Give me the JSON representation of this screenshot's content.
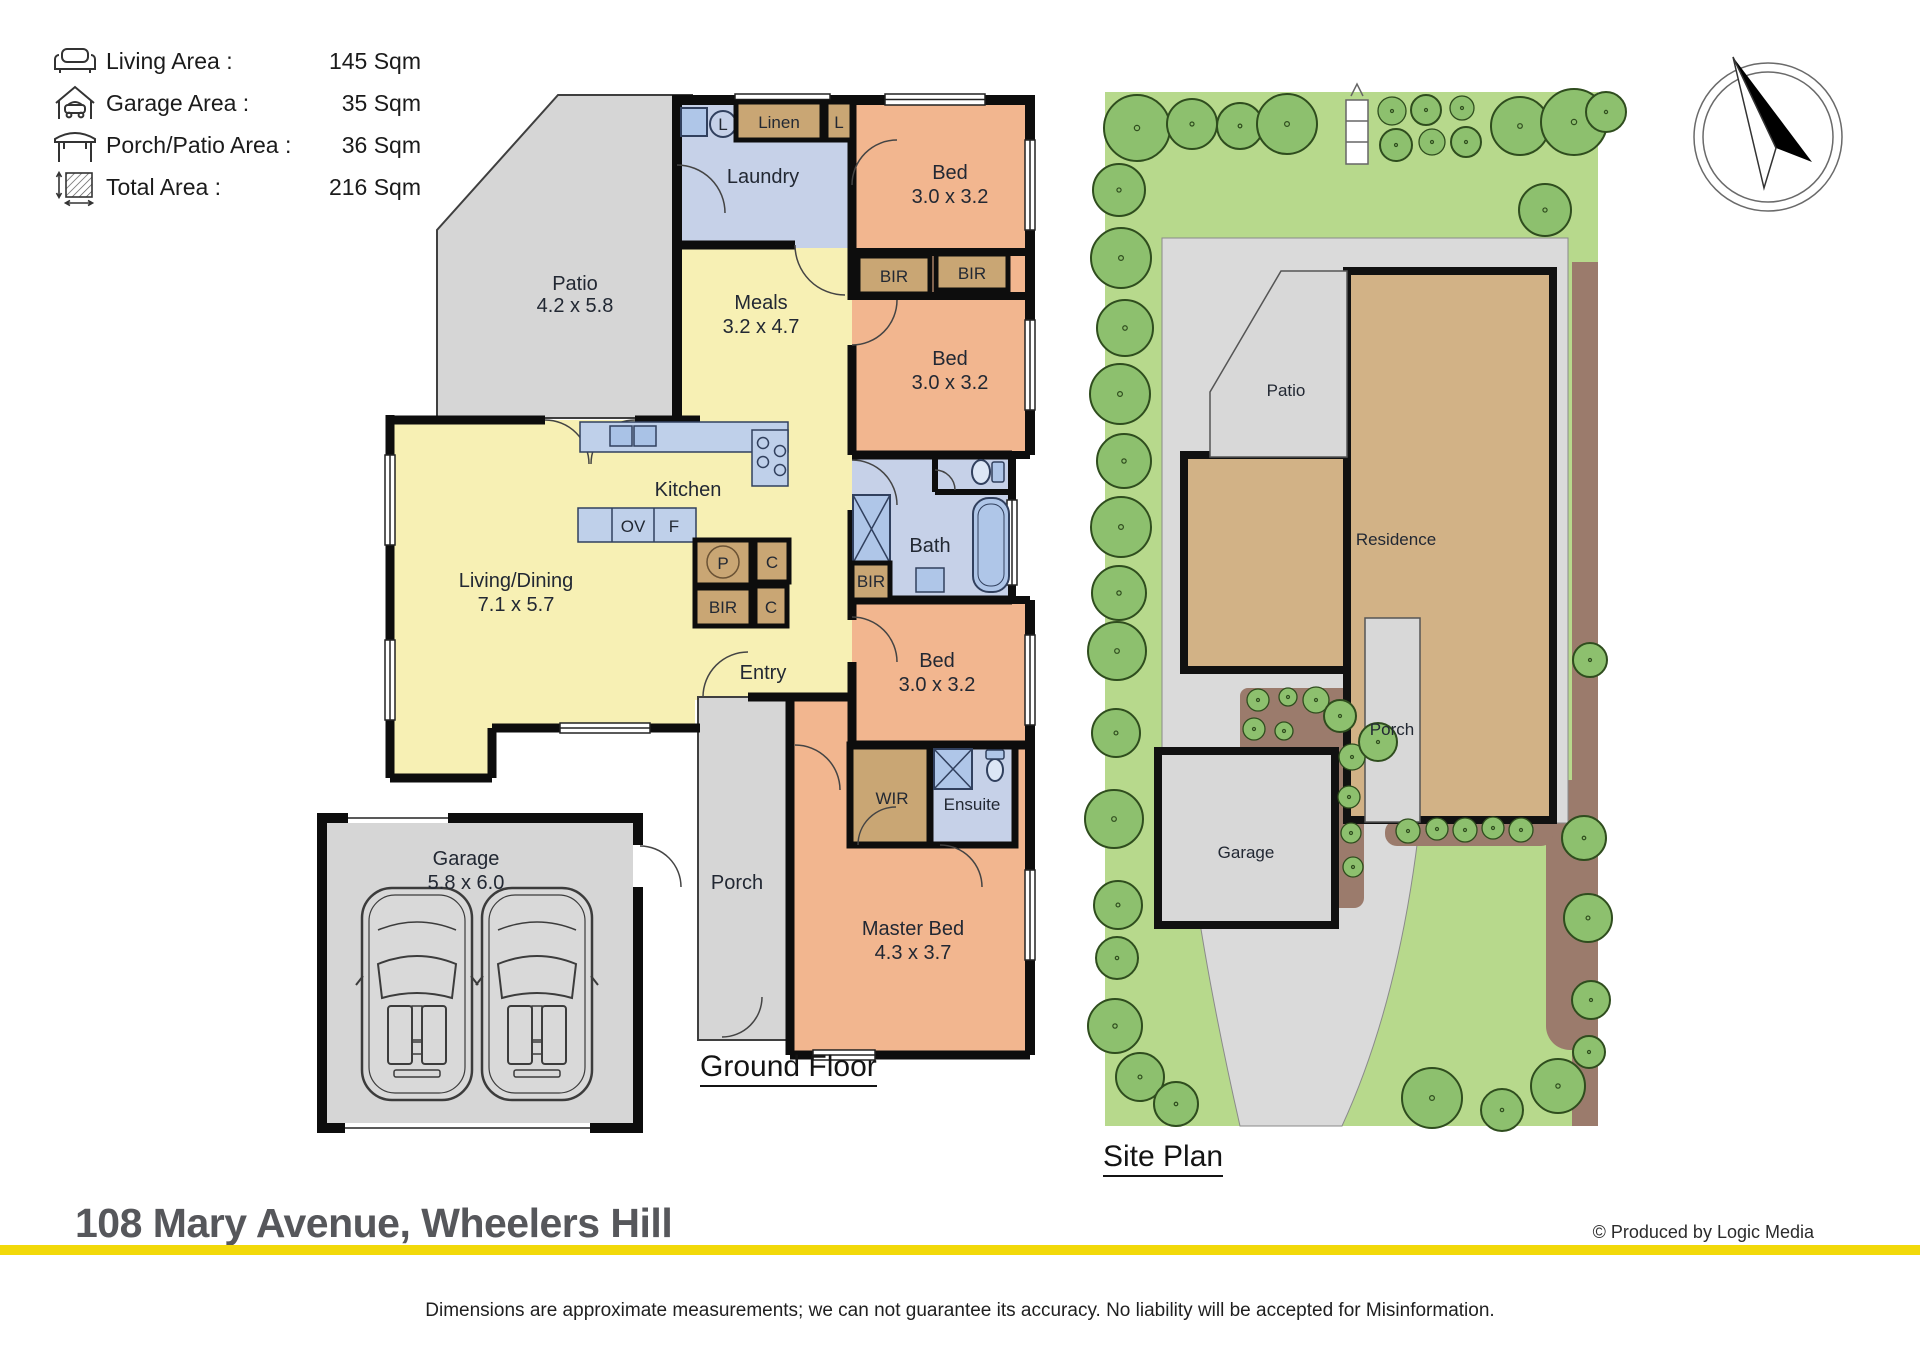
{
  "legend": {
    "rows": [
      {
        "icon": "sofa-icon",
        "label": "Living Area :",
        "value": "145 Sqm"
      },
      {
        "icon": "garage-icon",
        "label": "Garage Area :",
        "value": "35 Sqm"
      },
      {
        "icon": "canopy-icon",
        "label": "Porch/Patio Area :",
        "value": "36 Sqm"
      },
      {
        "icon": "area-icon",
        "label": "Total Area :",
        "value": "216 Sqm"
      }
    ]
  },
  "floor_plan": {
    "heading": "Ground Floor",
    "rooms": {
      "patio": {
        "name": "Patio",
        "dims": "4.2 x 5.8"
      },
      "laundry": {
        "name": "Laundry"
      },
      "linen": {
        "name": "Linen"
      },
      "linen_l": {
        "name": "L"
      },
      "tub_l": {
        "name": "L"
      },
      "bed1": {
        "name": "Bed",
        "dims": "3.0 x 3.2"
      },
      "bed2": {
        "name": "Bed",
        "dims": "3.0 x 3.2"
      },
      "bed3": {
        "name": "Bed",
        "dims": "3.0 x 3.2"
      },
      "meals": {
        "name": "Meals",
        "dims": "3.2 x 4.7"
      },
      "kitchen": {
        "name": "Kitchen"
      },
      "living": {
        "name": "Living/Dining",
        "dims": "7.1 x 5.7"
      },
      "bath": {
        "name": "Bath"
      },
      "entry": {
        "name": "Entry"
      },
      "wir": {
        "name": "WIR"
      },
      "ensuite": {
        "name": "Ensuite"
      },
      "porch": {
        "name": "Porch"
      },
      "master": {
        "name": "Master Bed",
        "dims": "4.3 x 3.7"
      },
      "garage": {
        "name": "Garage",
        "dims": "5.8 x 6.0"
      },
      "bir1": "BIR",
      "bir2": "BIR",
      "bir3": "BIR",
      "bir4": "BIR",
      "ov": "OV",
      "f": "F",
      "p": "P",
      "c1": "C",
      "c2": "C"
    }
  },
  "site_plan": {
    "heading": "Site Plan",
    "labels": {
      "patio": "Patio",
      "residence": "Residence",
      "porch": "Porch",
      "garage": "Garage"
    }
  },
  "footer": {
    "address": "108 Mary Avenue, Wheelers Hill",
    "credit_symbol": "©",
    "credit": "Produced by Logic Media",
    "disclaimer": "Dimensions are approximate measurements; we can not guarantee its accuracy. No liability will be accepted for Misinformation."
  },
  "colors": {
    "living_yellow": "#f7f0b4",
    "bed_orange": "#f2b68f",
    "wet_blue": "#c6d1e8",
    "cabinet_tan": "#c9a674",
    "outdoor_gray": "#d6d6d6",
    "lawn_green": "#b7d98c",
    "tree_green": "#8dc06e",
    "garden_brown": "#9b7b6c",
    "residence_tan": "#d2b286",
    "accent_yellow": "#f2d90a",
    "title_gray": "#56575b"
  }
}
